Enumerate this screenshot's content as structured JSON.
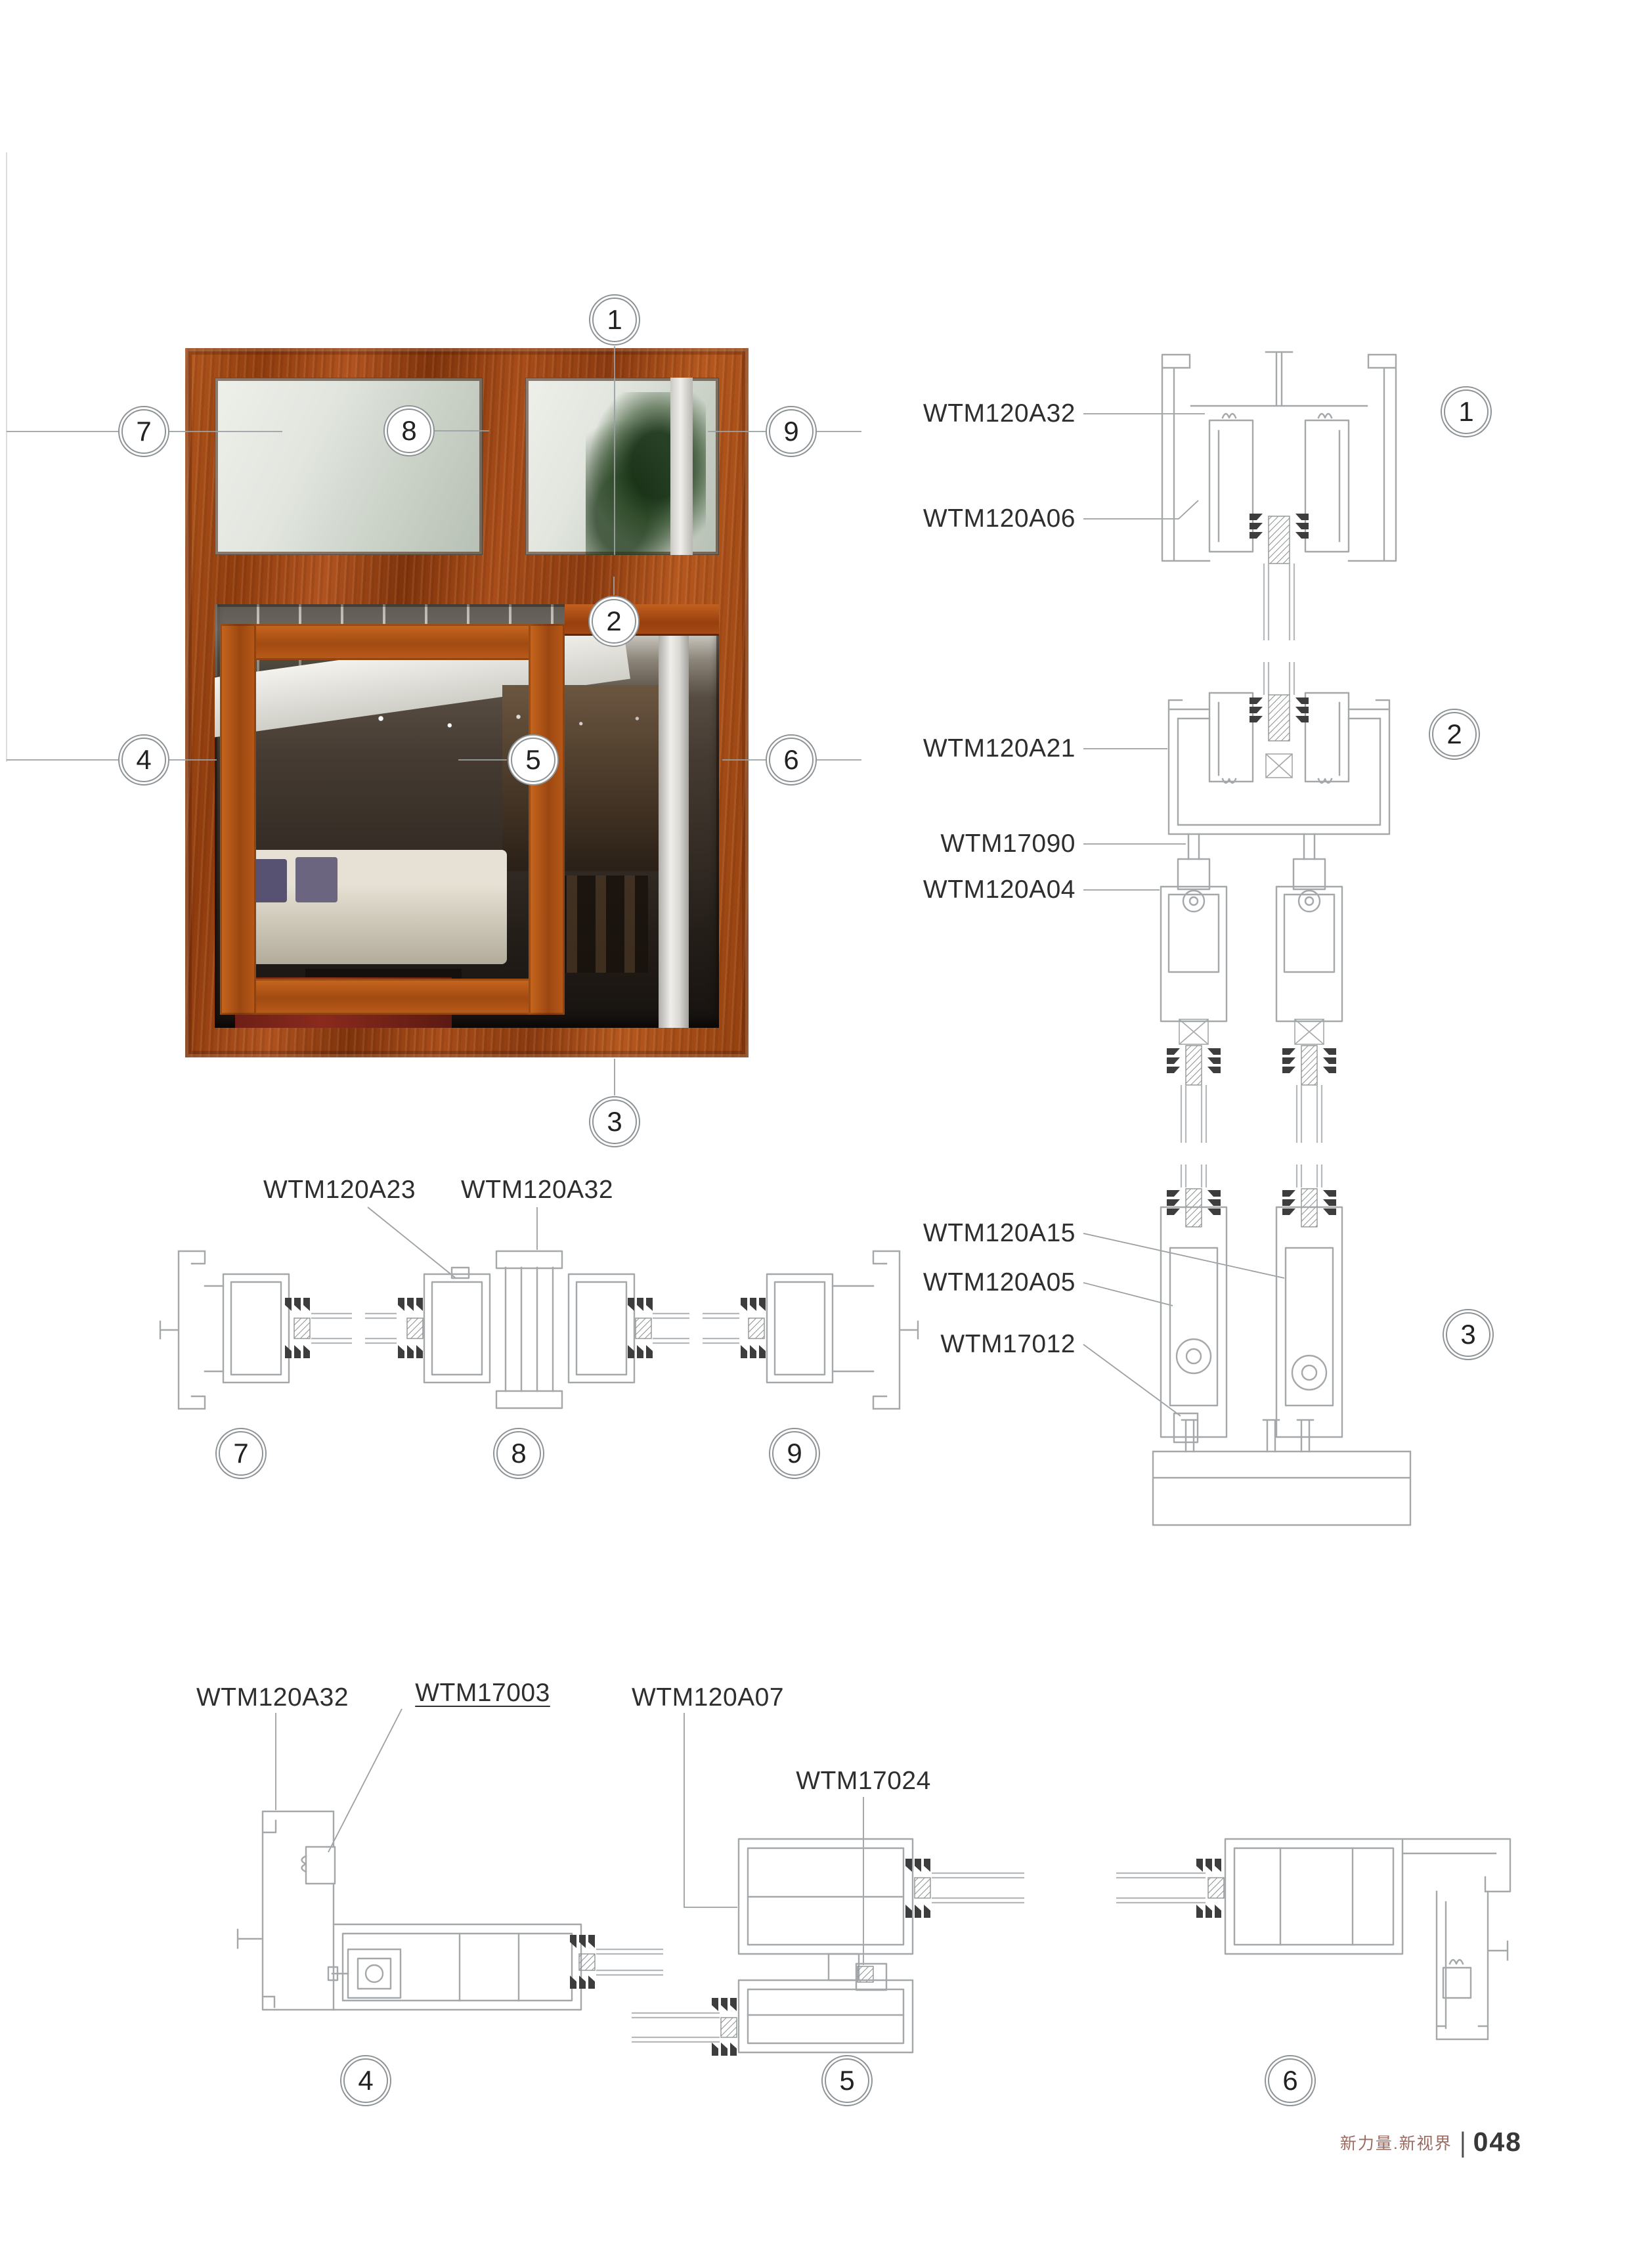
{
  "footer": {
    "brand": "新力量.新视界",
    "divider": "|",
    "page_number": "048"
  },
  "callouts": {
    "n1": "1",
    "n2": "2",
    "n3": "3",
    "n4": "4",
    "n5": "5",
    "n6": "6",
    "n7": "7",
    "n8": "8",
    "n9": "9"
  },
  "labels": {
    "d1_a": "WTM120A32",
    "d1_b": "WTM120A06",
    "d2_a": "WTM120A21",
    "d2_b": "WTM17090",
    "d2_c": "WTM120A04",
    "d3_a": "WTM120A15",
    "d3_b": "WTM120A05",
    "d3_c": "WTM17012",
    "mid_a": "WTM120A23",
    "mid_b": "WTM120A32",
    "bot_a": "WTM120A32",
    "bot_b": "WTM17003",
    "bot_c": "WTM120A07",
    "bot_d": "WTM17024"
  }
}
